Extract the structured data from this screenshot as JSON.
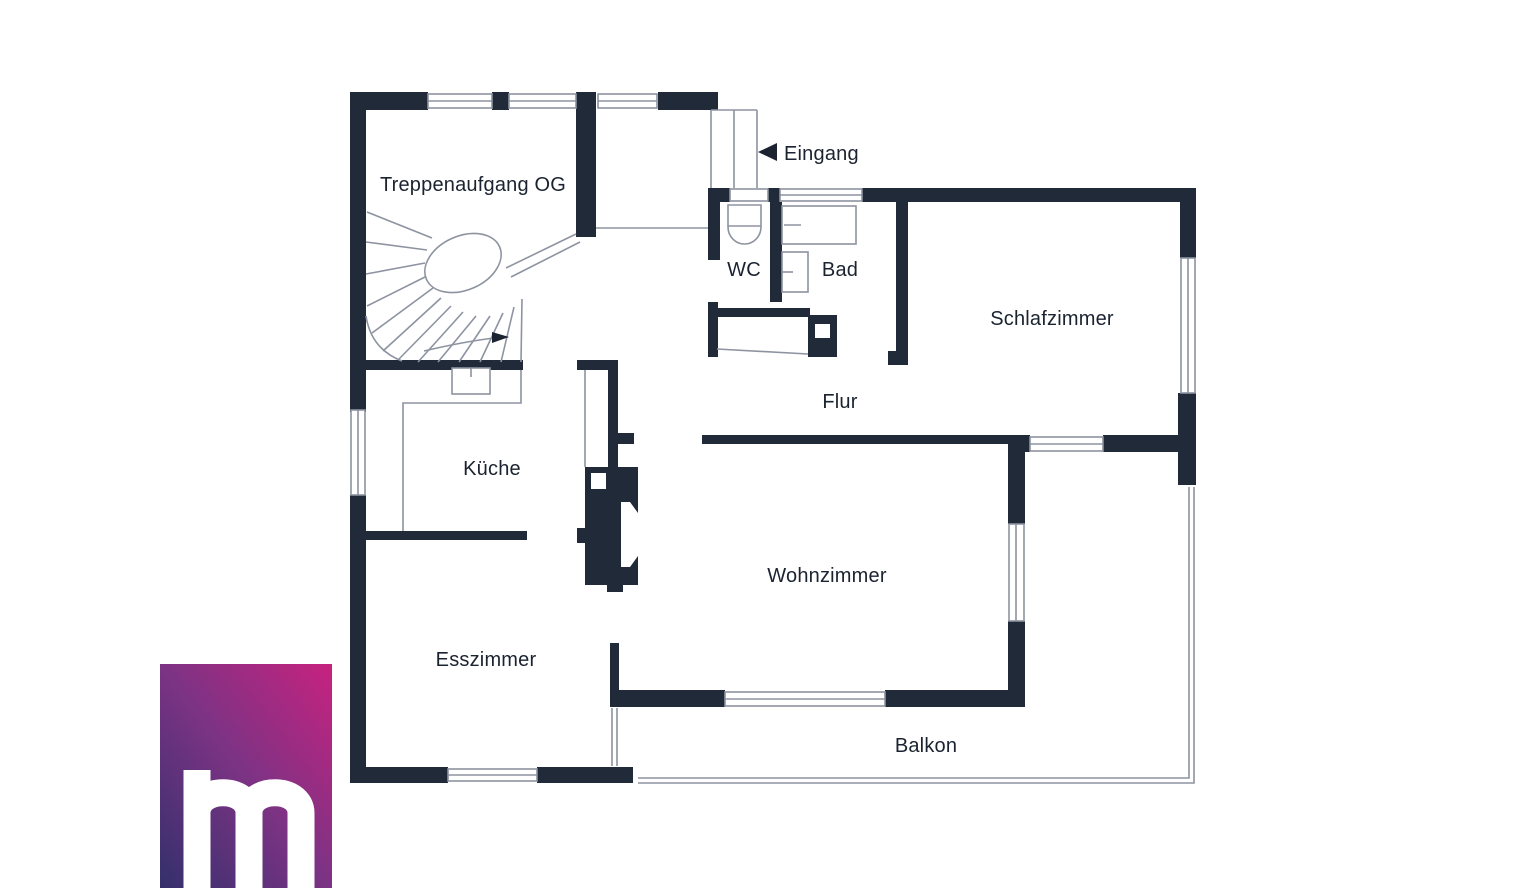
{
  "plan": {
    "labels": {
      "treppenaufgang": "Treppenaufgang OG",
      "eingang": "Eingang",
      "wc": "WC",
      "bad": "Bad",
      "schlafzimmer": "Schlafzimmer",
      "flur": "Flur",
      "kueche": "Küche",
      "wohnzimmer": "Wohnzimmer",
      "esszimmer": "Esszimmer",
      "balkon": "Balkon"
    },
    "colors": {
      "wall": "#202a39",
      "line": "#8d93a0",
      "text": "#1b2330"
    }
  },
  "logo": {
    "letter": "m",
    "letter_color": "#ffffff",
    "gradient": {
      "from": "#34306c",
      "mid": "#7c3384",
      "to": "#c7227f"
    }
  }
}
